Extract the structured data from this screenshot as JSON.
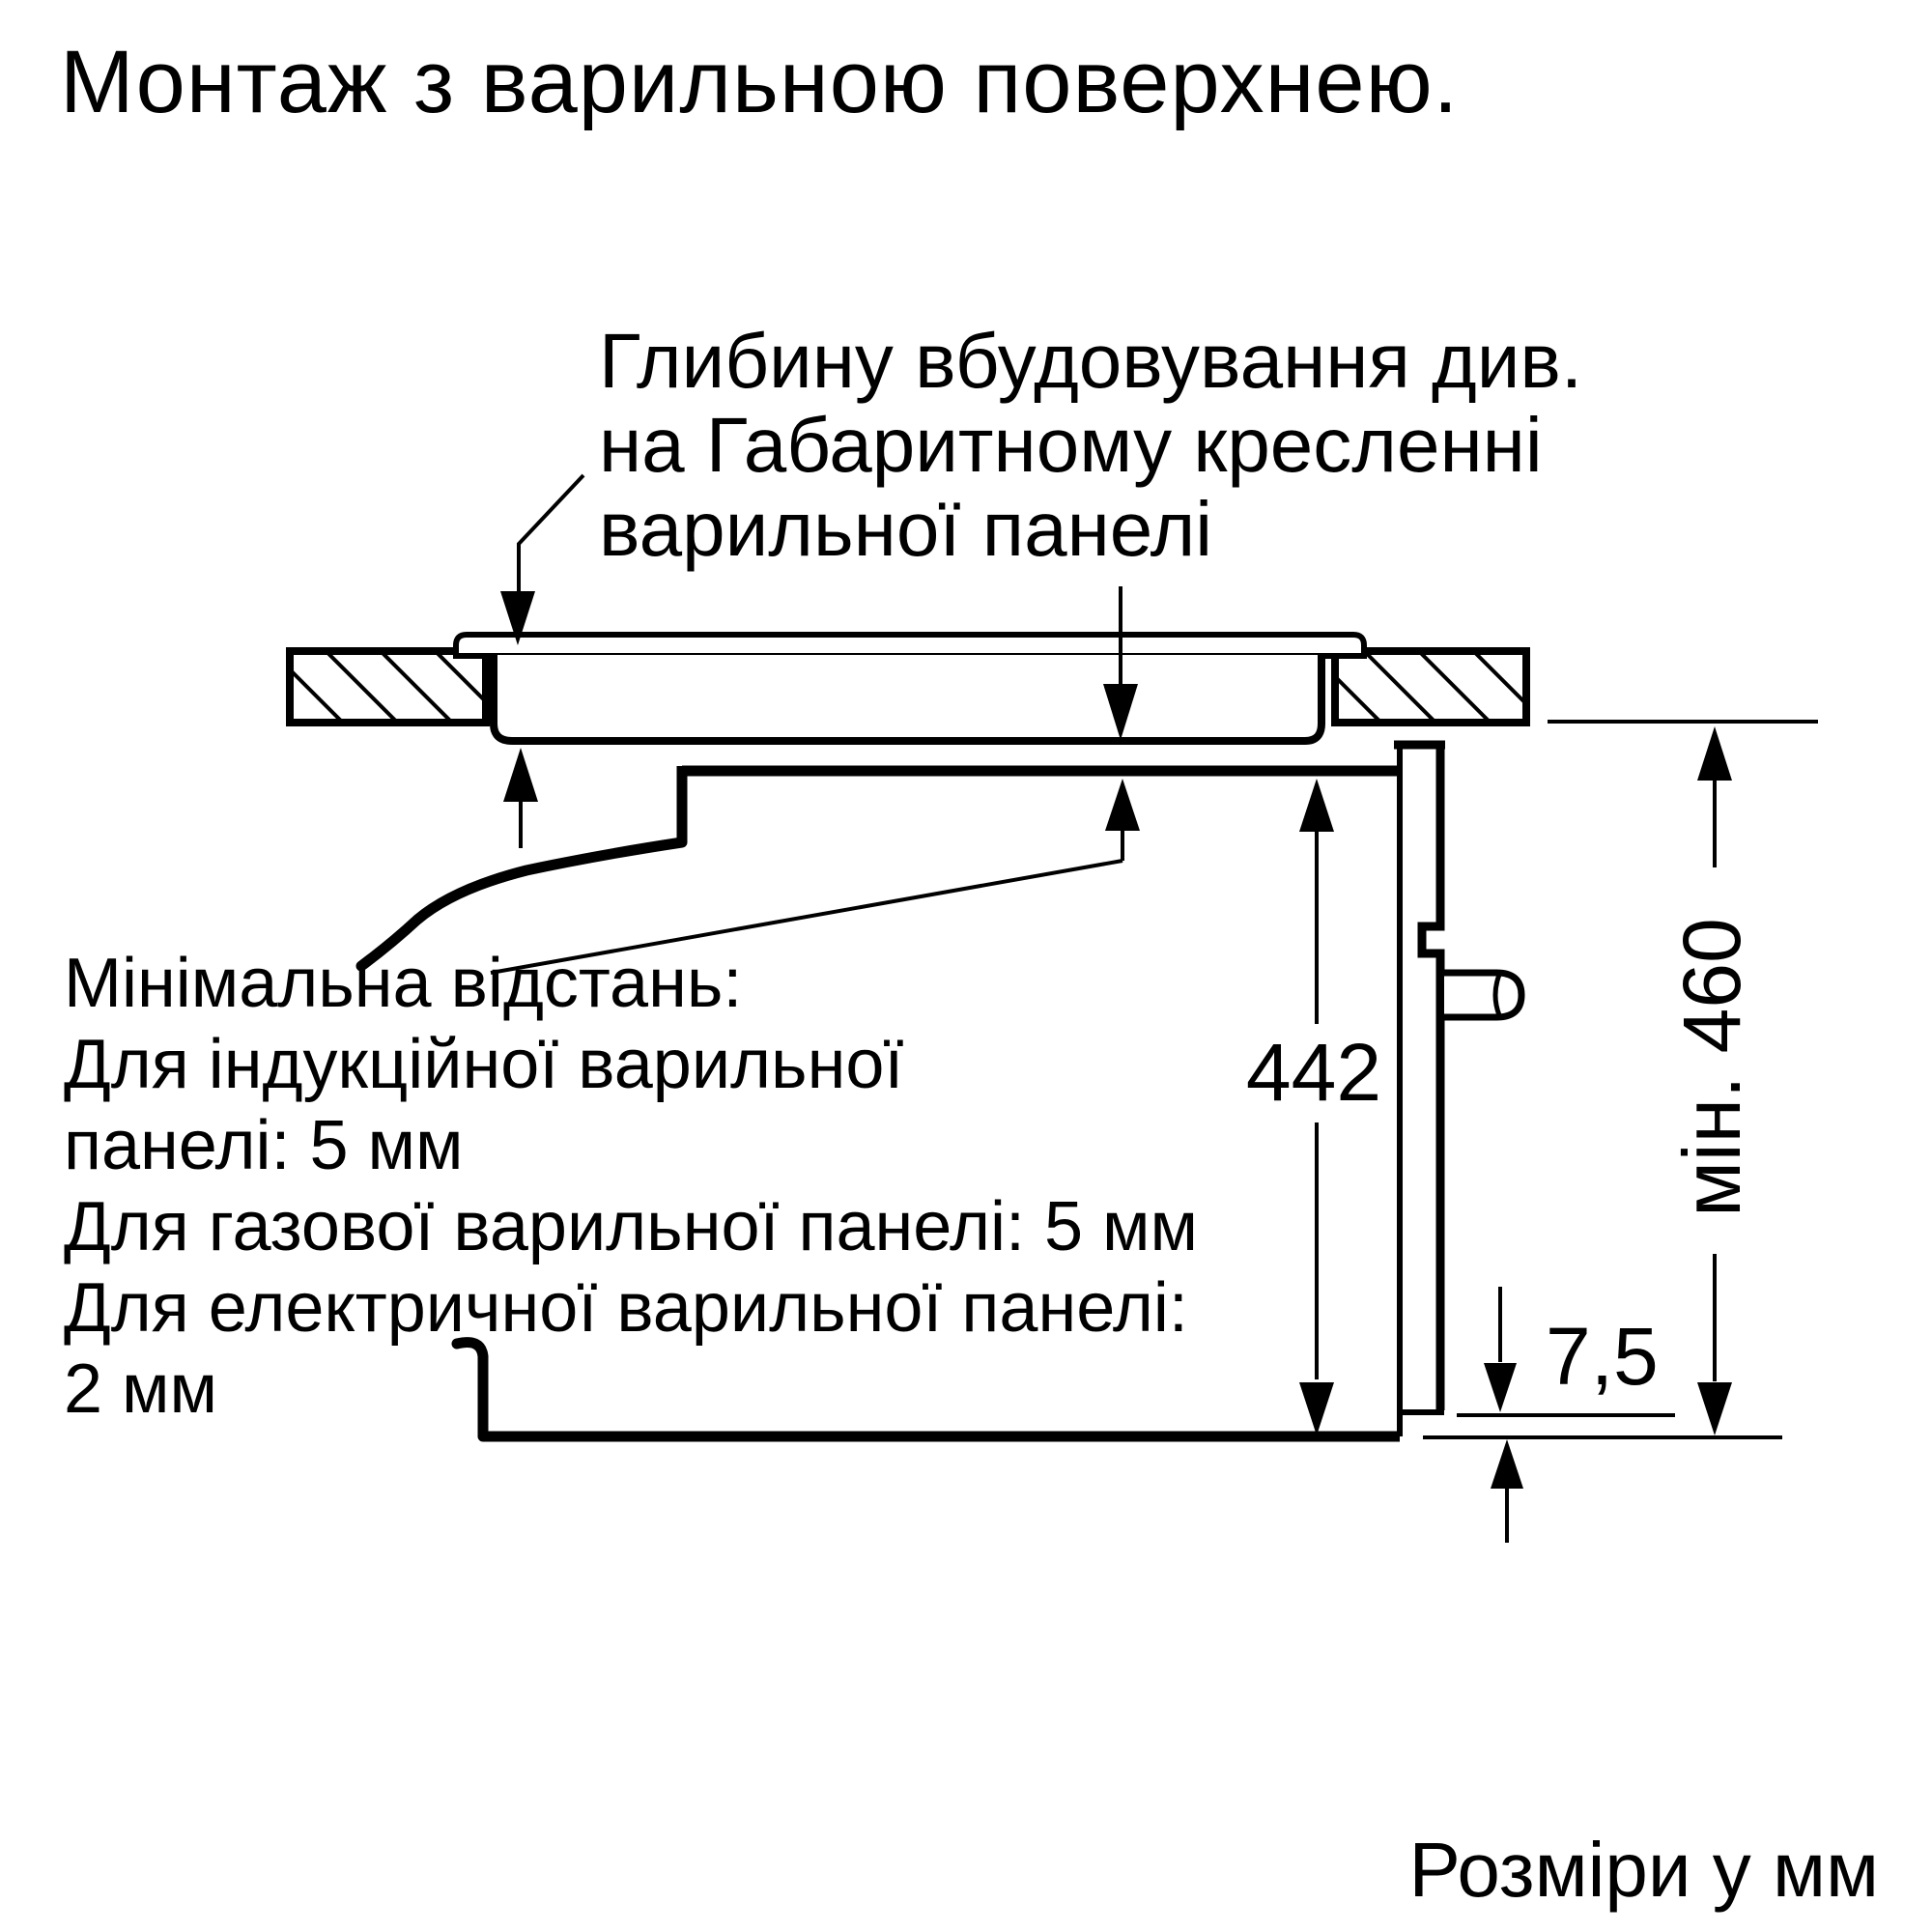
{
  "title": "Монтаж з варильною поверхнею.",
  "callout_top": {
    "line1": "Глибину вбудовування див.",
    "line2": "на Габаритному кресленні",
    "line3": "варильної панелі"
  },
  "callout_left": {
    "line1": "Мінімальна відстань:",
    "line2": "Для індукційної варильної",
    "line3": "панелі: 5 мм",
    "line4": "Для газової варильної панелі: 5 мм",
    "line5": "Для електричної варильної панелі:",
    "line6": "2 мм"
  },
  "dimensions": {
    "oven_height": "442",
    "niche_min_height": "мін. 460",
    "bottom_gap": "7,5"
  },
  "footer": {
    "units_note": "Розміри у мм"
  },
  "colors": {
    "ink": "#000000",
    "background": "#ffffff"
  }
}
